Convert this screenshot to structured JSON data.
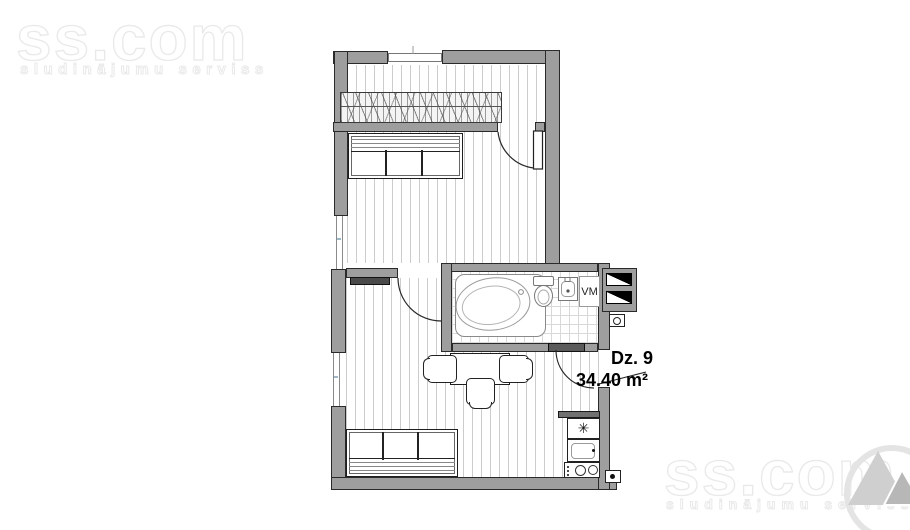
{
  "watermarks": {
    "top_left": {
      "brand": "ss.com",
      "tagline": "sludinājumu serviss"
    },
    "bottom_right": {
      "brand": "ss.com",
      "tagline": "sludinājumu serviss"
    }
  },
  "unit_label": {
    "name": "Dz. 9",
    "area": "34.40 m²"
  },
  "labels": {
    "washing_machine": "VM"
  },
  "icons": {
    "fridge_snowflake": "✳"
  },
  "colors": {
    "wall_fill": "#9e9e9e",
    "wall_outline": "#2a2a2a",
    "floor_line": "#cccccc",
    "tile_line": "#d9d9d9",
    "fixture_line": "#8a8a8a",
    "label_text": "#000000",
    "watermark_stroke": "#e9e9e9",
    "window_accent": "#9fb8c8",
    "dark_furniture": "#4a4a4a"
  }
}
